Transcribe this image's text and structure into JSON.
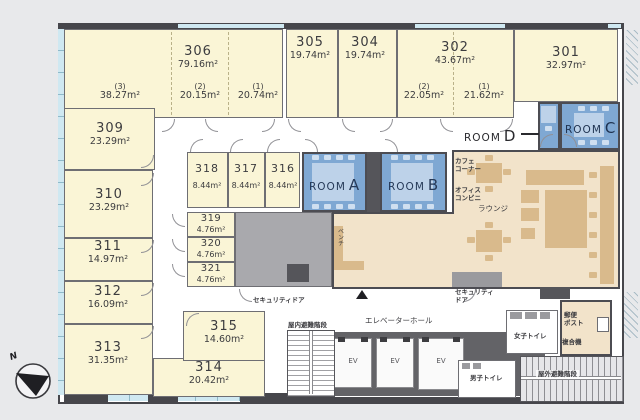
{
  "plan_title": "office-floor-plan",
  "palette": {
    "office_room": "#FAF5D6",
    "meeting_room": "#7FA8D3",
    "lounge": "#F2E3CA",
    "furniture": "#D9BA8C",
    "wall": "#46464B",
    "window": "#CFE8F1"
  },
  "compass": {
    "north": "N"
  },
  "offices": [
    {
      "id": "306",
      "area": "79.16m²",
      "sections": [
        {
          "label": "(3)",
          "area": "38.27m²"
        },
        {
          "label": "(2)",
          "area": "20.15m²"
        },
        {
          "label": "(1)",
          "area": "20.74m²"
        }
      ]
    },
    {
      "id": "305",
      "area": "19.74m²"
    },
    {
      "id": "304",
      "area": "19.74m²"
    },
    {
      "id": "302",
      "area": "43.67m²",
      "sections": [
        {
          "label": "(2)",
          "area": "22.05m²"
        },
        {
          "label": "(1)",
          "area": "21.62m²"
        }
      ]
    },
    {
      "id": "301",
      "area": "32.97m²"
    },
    {
      "id": "309",
      "area": "23.29m²"
    },
    {
      "id": "310",
      "area": "23.29m²"
    },
    {
      "id": "311",
      "area": "14.97m²"
    },
    {
      "id": "312",
      "area": "16.09m²"
    },
    {
      "id": "313",
      "area": "31.35m²"
    },
    {
      "id": "314",
      "area": "20.42m²"
    },
    {
      "id": "315",
      "area": "14.60m²"
    },
    {
      "id": "316",
      "area": "8.44m²"
    },
    {
      "id": "317",
      "area": "8.44m²"
    },
    {
      "id": "318",
      "area": "8.44m²"
    },
    {
      "id": "319",
      "area": "4.76m²"
    },
    {
      "id": "320",
      "area": "4.76m²"
    },
    {
      "id": "321",
      "area": "4.76m²"
    }
  ],
  "meeting_rooms": {
    "a": {
      "word": "ROOM",
      "letter": "A"
    },
    "b": {
      "word": "ROOM",
      "letter": "B"
    },
    "c": {
      "word": "ROOM",
      "letter": "C"
    },
    "d": {
      "word": "ROOM",
      "letter": "D"
    }
  },
  "labels": {
    "ev": "EV",
    "elevator_hall": "エレベーターホール",
    "security_door_left": "セキュリティドア",
    "security_door_right_l1": "セキュリティ",
    "security_door_right_l2": "ドア",
    "indoor_stairs": "屋内避難階段",
    "outdoor_stairs": "屋外避難階段",
    "mens_toilet": "男子トイレ",
    "womens_toilet": "女子トイレ",
    "mail_l1": "郵便",
    "mail_l2": "ポスト",
    "copier": "複合機",
    "cafe_l1": "カフェ",
    "cafe_l2": "コーナー",
    "convenience_l1": "オフィス",
    "convenience_l2": "コンビニ",
    "lounge": "ラウンジ",
    "bench": "ベンチ"
  }
}
